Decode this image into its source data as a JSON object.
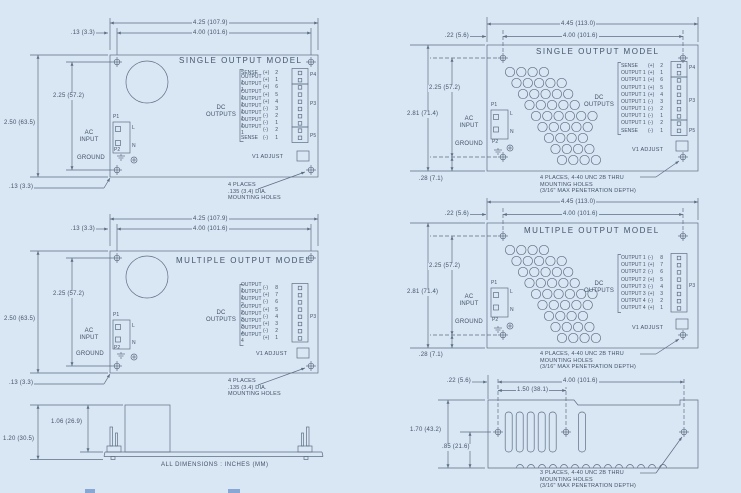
{
  "colors": {
    "background": "#d9e6f3",
    "line": "#5d6e83",
    "text": "#43556a",
    "artifact": "#5b87c5"
  },
  "shared": {
    "ac_input": "AC\nINPUT",
    "ground": "GROUND",
    "dc_outputs": "DC\nOUTPUTS",
    "p1": "P1",
    "p2": "P2",
    "p3": "P3",
    "p4": "P4",
    "p5": "P5",
    "l": "L",
    "n": "N",
    "v1_adjust": "V1 ADJUST"
  },
  "single_pins": [
    [
      "SENSE",
      "(+)",
      "2"
    ],
    [
      "OUTPUT 1",
      "(+)",
      "1"
    ],
    [
      "OUTPUT 1",
      "(+)",
      "6"
    ],
    [
      "OUTPUT 1",
      "(+)",
      "5"
    ],
    [
      "OUTPUT 1",
      "(+)",
      "4"
    ],
    [
      "OUTPUT 1",
      "(-)",
      "3"
    ],
    [
      "OUTPUT 1",
      "(-)",
      "2"
    ],
    [
      "OUTPUT 1",
      "(-)",
      "1"
    ],
    [
      "OUTPUT 1",
      "(-)",
      "2"
    ],
    [
      "SENSE",
      "(-)",
      "1"
    ]
  ],
  "multi_pins": [
    [
      "OUTPUT 1",
      "(-)",
      "8"
    ],
    [
      "OUTPUT 1",
      "(+)",
      "7"
    ],
    [
      "OUTPUT 2",
      "(-)",
      "6"
    ],
    [
      "OUTPUT 2",
      "(+)",
      "5"
    ],
    [
      "OUTPUT 3",
      "(-)",
      "4"
    ],
    [
      "OUTPUT 3",
      "(+)",
      "3"
    ],
    [
      "OUTPUT 4",
      "(-)",
      "2"
    ],
    [
      "OUTPUT 4",
      "(+)",
      "1"
    ]
  ],
  "fig_tl": {
    "title": "SINGLE OUTPUT MODEL",
    "dim_width_overall": "4.25 (107.9)",
    "dim_width_holes": "4.00 (101.6)",
    "dim_edge_top": ".13 (3.3)",
    "dim_height_holes": "2.25 (57.2)",
    "dim_height_overall": "2.50 (63.5)",
    "dim_edge_bottom": ".13 (3.3)",
    "note": "4 PLACES\n.135 (3.4) DIA.\nMOUNTING HOLES"
  },
  "fig_ml": {
    "title": "MULTIPLE OUTPUT MODEL",
    "dim_width_overall": "4.25 (107.9)",
    "dim_width_holes": "4.00 (101.6)",
    "dim_edge_top": ".13 (3.3)",
    "dim_height_holes": "2.25 (57.2)",
    "dim_height_overall": "2.50 (63.5)",
    "dim_edge_bottom": ".13 (3.3)",
    "note": "4 PLACES\n.135 (3.4) DIA.\nMOUNTING HOLES"
  },
  "fig_tr": {
    "title": "SINGLE OUTPUT MODEL",
    "dim_width_overall": "4.45 (113.0)",
    "dim_width_holes": "4.00 (101.6)",
    "dim_edge_left": ".22 (5.6)",
    "dim_height_holes": "2.25 (57.2)",
    "dim_height_overall": "2.81 (71.4)",
    "dim_edge_bottom": ".28 (7.1)",
    "note": "4 PLACES, 4-40 UNC 2B THRU\nMOUNTING HOLES\n(3/16\" MAX PENETRATION DEPTH)"
  },
  "fig_mr": {
    "title": "MULTIPLE OUTPUT MODEL",
    "dim_width_overall": "4.45 (113.0)",
    "dim_width_holes": "4.00 (101.6)",
    "dim_edge_left": ".22 (5.6)",
    "dim_height_holes": "2.25 (57.2)",
    "dim_height_overall": "2.81 (71.4)",
    "dim_edge_bottom": ".28 (7.1)",
    "note": "4 PLACES, 4-40 UNC 2B THRU\nMOUNTING HOLES\n(3/16\" MAX PENETRATION DEPTH)"
  },
  "fig_bl": {
    "dim_component_height": "1.06 (26.9)",
    "dim_overall_height": "1.20 (30.5)",
    "footnote": "ALL DIMENSIONS :   INCHES (MM)"
  },
  "fig_br": {
    "dim_edge_left": ".22 (5.6)",
    "dim_width_holes": "4.00 (101.6)",
    "dim_hole_spacing": "1.50 (38.1)",
    "dim_height_overall": "1.70 (43.2)",
    "dim_hole_height": ".85 (21.6)",
    "note": "3 PLACES, 4-40 UNC 2B THRU\nMOUNTING HOLES\n(3/16\" MAX PENETRATION DEPTH)"
  }
}
